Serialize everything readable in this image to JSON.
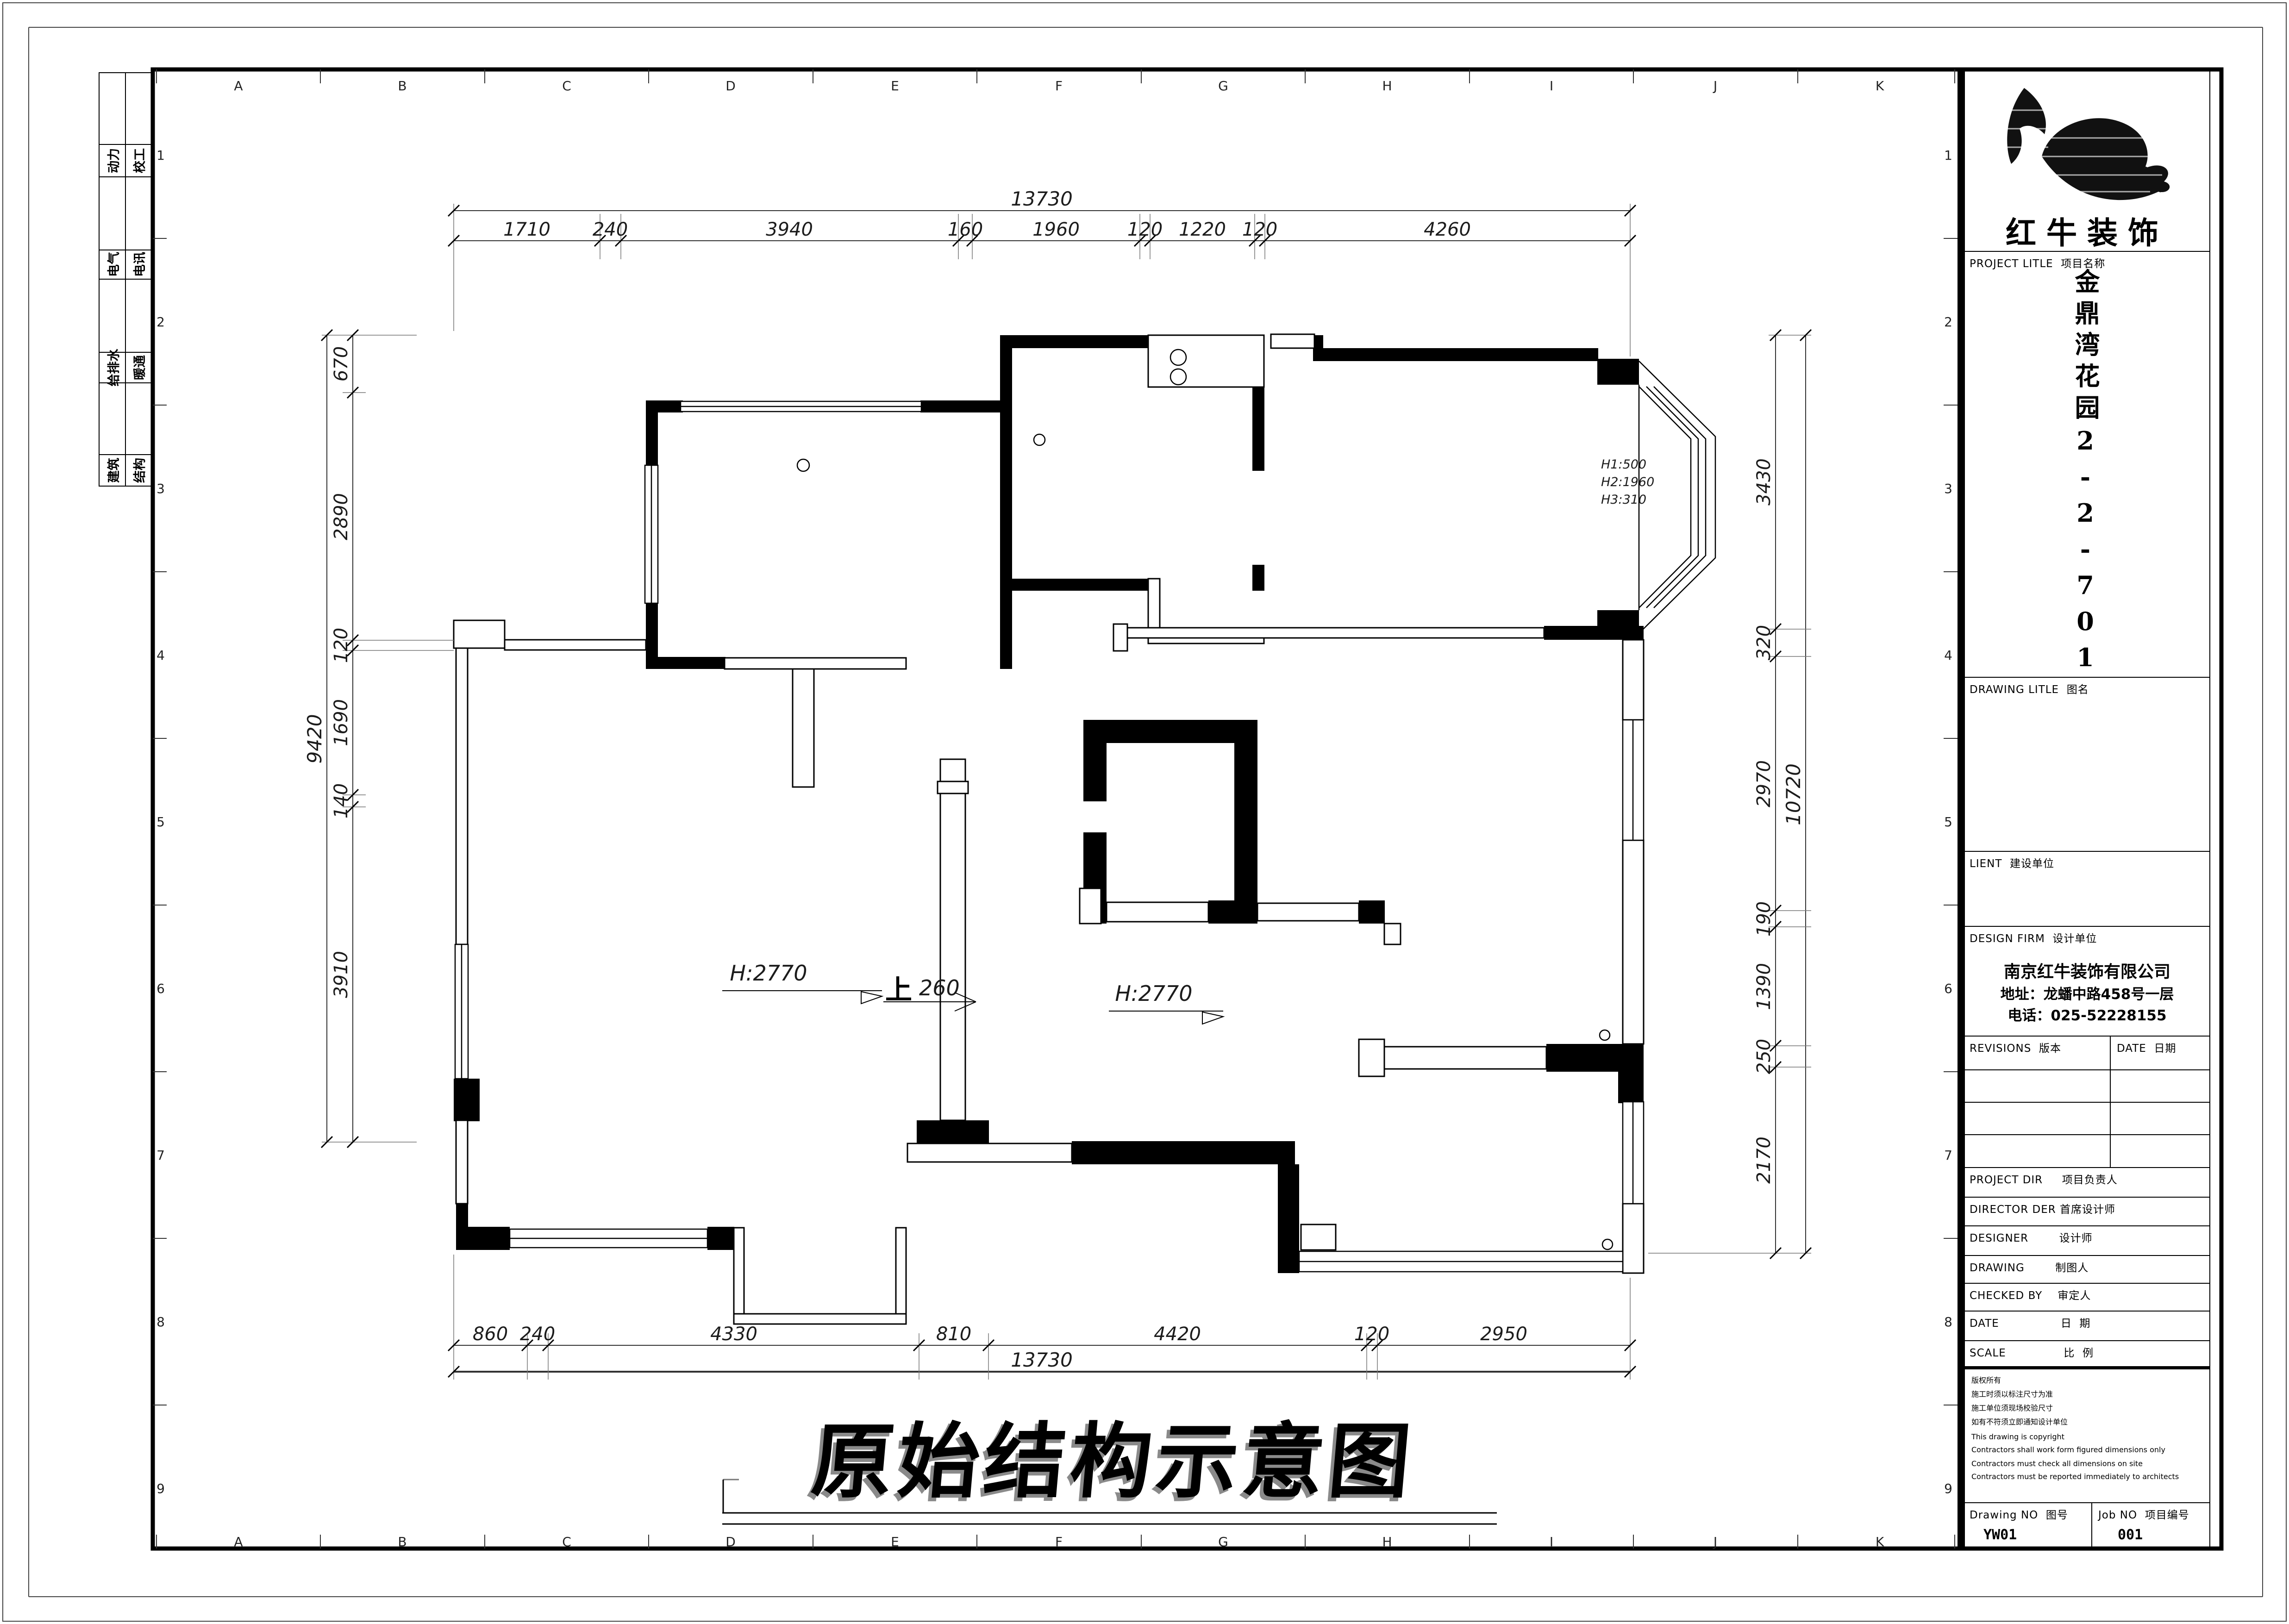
{
  "brand": {
    "name": "红牛装饰"
  },
  "title_block": {
    "project_title_label": "PROJECT LITLE  项目名称",
    "project_name": "金鼎湾花园2-2-701",
    "drawing_title_label": "DRAWING LITLE  图名",
    "client_label": "LIENT  建设单位",
    "design_firm_label": "DESIGN FIRM  设计单位",
    "firm_name": "南京红牛装饰有限公司",
    "firm_address": "地址：龙蟠中路458号一层",
    "firm_phone": "电话：025-52228155",
    "revisions_label": "REVISIONS  版本",
    "date_label": "DATE  日期",
    "project_dir_label": "PROJECT DIR     项目负责人",
    "director_label": "DIRECTOR DER 首席设计师",
    "designer_label": "DESIGNER        设计师",
    "drawing_by_label": "DRAWING        制图人",
    "checked_by_label": "CHECKED BY    审定人",
    "date2_label": "DATE                日  期",
    "scale_label": "SCALE               比  例",
    "copyright_lines": [
      "版权所有",
      "施工时须以标注尺寸为准",
      "施工单位须现场校验尺寸",
      "如有不符须立即通知设计单位",
      "This drawing is copyright",
      "Contractors shall work form figured dimensions only",
      "Contractors must check all dimensions on site",
      "Contractors must be reported immediately to architects"
    ],
    "drawing_no_label": "Drawing NO  图号",
    "drawing_no": "YW01",
    "job_no_label": "Job NO  项目编号",
    "job_no": "001"
  },
  "grid": {
    "letters": [
      "A",
      "B",
      "C",
      "D",
      "E",
      "F",
      "G",
      "H",
      "I",
      "J",
      "K"
    ],
    "numbers": [
      "1",
      "2",
      "3",
      "4",
      "5",
      "6",
      "7",
      "8",
      "9"
    ]
  },
  "disciplines": [
    "动力",
    "校工",
    "电气",
    "电讯",
    "给排水",
    "暖通",
    "建筑",
    "结构"
  ],
  "dims": {
    "top_overall": "13730",
    "top": [
      "1710",
      "240",
      "3940",
      "160",
      "1960",
      "120",
      "1220",
      "120",
      "4260"
    ],
    "bottom": [
      "860",
      "240",
      "4330",
      "810",
      "4420",
      "120",
      "2950"
    ],
    "bottom_overall": "13730",
    "left": [
      "670",
      "2890",
      "120",
      "1690",
      "140",
      "3910"
    ],
    "left_overall": "9420",
    "right": [
      "3430",
      "320",
      "2970",
      "190",
      "1390",
      "250",
      "2170"
    ],
    "right_overall": "10720"
  },
  "plan": {
    "title": "原始结构示意图",
    "room_height_a": "H:2770",
    "room_height_b": "H:2770",
    "stair_up": "上",
    "stair_value": "260",
    "bay_note": [
      "H1:500",
      "H2:1960",
      "H3:310"
    ]
  }
}
